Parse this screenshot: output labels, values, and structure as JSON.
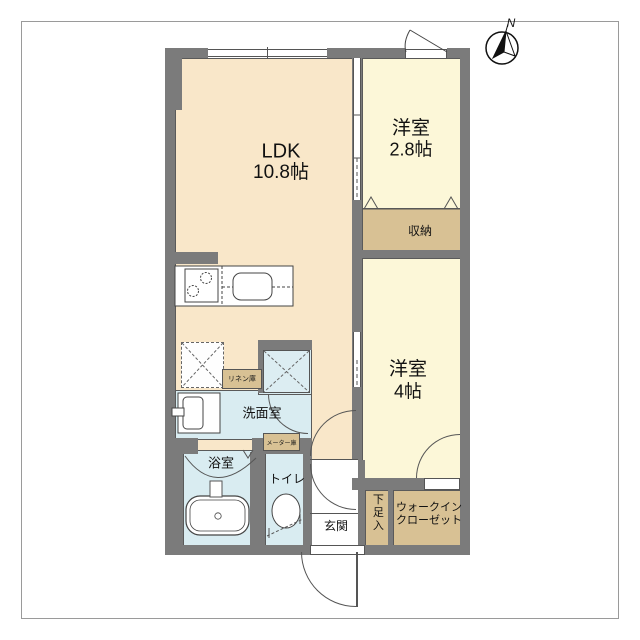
{
  "plan_title": "1LDK apartment floor plan",
  "compass": {
    "north": "N"
  },
  "rooms": {
    "ldk": {
      "name": "LDK",
      "size": "10.8帖"
    },
    "bedroom1": {
      "name": "洋室",
      "size": "2.8帖"
    },
    "bedroom2": {
      "name": "洋室",
      "size": "4帖"
    },
    "closet": {
      "label": "収納"
    },
    "wic": {
      "line1": "ウォークイン",
      "line2": "クローゼット"
    },
    "shoe": {
      "label": "下足入"
    },
    "genkan": {
      "label": "玄関"
    },
    "toilet": {
      "label": "トイレ"
    },
    "bath": {
      "label": "浴室"
    },
    "washroom": {
      "label": "洗面室"
    },
    "linen": {
      "label": "リネン庫"
    },
    "meter": {
      "label": "メーター庫"
    }
  },
  "fixtures": [
    "kitchen-counter",
    "stove-burners",
    "kitchen-sink",
    "refrigerator-space",
    "washing-machine-space",
    "vanity-basin",
    "bathtub",
    "toilet-bowl"
  ],
  "colors": {
    "wall": "#7b7b7b",
    "ldk_floor": "#f9e7c9",
    "bedroom_floor": "#fcf7d8",
    "storage_floor": "#d8c194",
    "wet_area_floor": "#d9ecf1",
    "outline": "#555555"
  }
}
